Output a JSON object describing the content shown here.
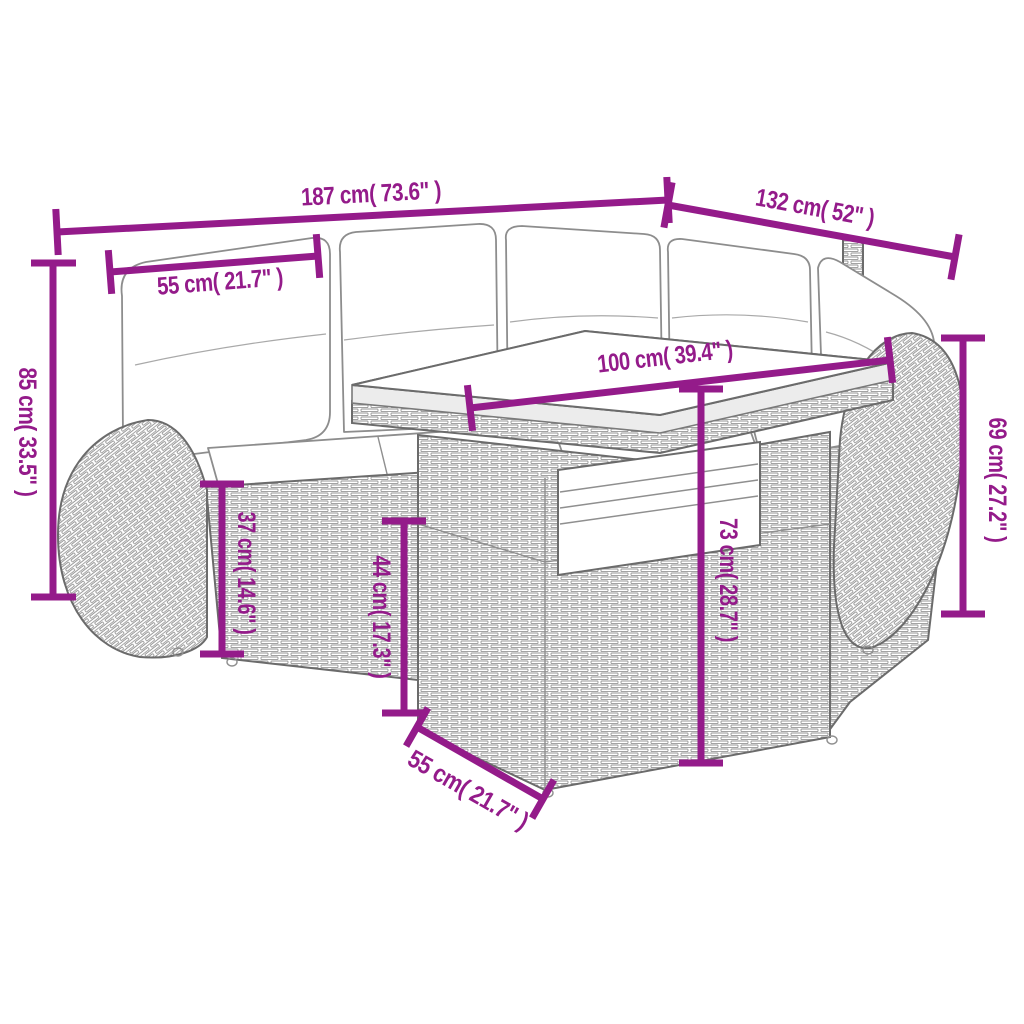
{
  "page": {
    "background": "#ffffff"
  },
  "diagram": {
    "type": "product-dimension-diagram",
    "subject": "poly-rattan garden lounge set: corner sofa with cushions and slatted-top table",
    "accent_color": "#941b8a",
    "dimensions": [
      {
        "name": "sofa-total-width",
        "label": "187 cm( 73.6\" )"
      },
      {
        "name": "sofa-total-depth",
        "label": "132 cm( 52\" )"
      },
      {
        "name": "seat-cushion-width",
        "label": "55 cm( 21.7\" )"
      },
      {
        "name": "sofa-back-height",
        "label": "85 cm( 33.5\" )"
      },
      {
        "name": "table-top-length",
        "label": "100 cm( 39.4\" )"
      },
      {
        "name": "arm-height",
        "label": "69 cm( 27.2\" )"
      },
      {
        "name": "seat-height",
        "label": "37 cm( 14.6\" )"
      },
      {
        "name": "table-base-height",
        "label": "44 cm( 17.3\" )"
      },
      {
        "name": "table-height",
        "label": "73 cm( 28.7\" )"
      },
      {
        "name": "table-top-width",
        "label": "55 cm( 21.7\" )"
      }
    ]
  }
}
